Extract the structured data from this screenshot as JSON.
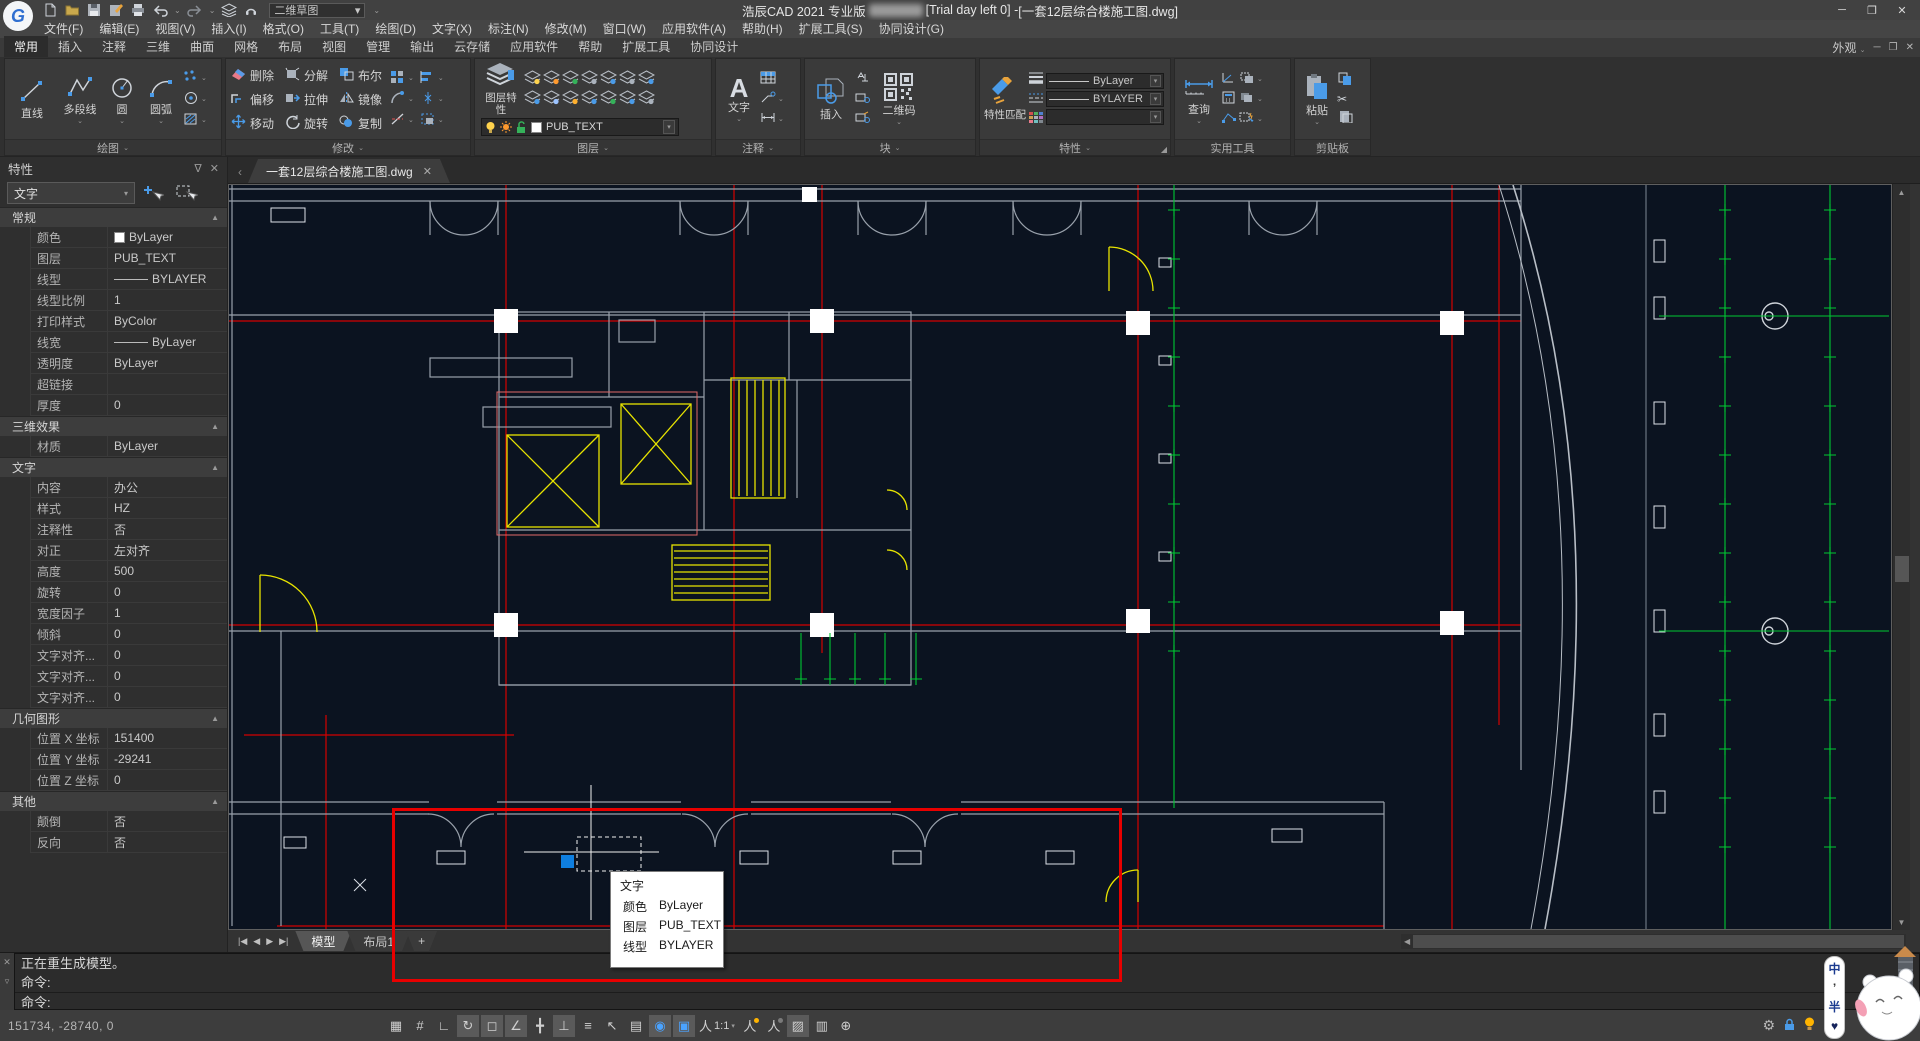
{
  "titlebar": {
    "app_name": "浩辰CAD 2021 专业版",
    "trial_text": "[Trial day left 0] - ",
    "doc_title": "[一套12层综合楼施工图.dwg]",
    "workspace": "二维草图",
    "minimize": "─",
    "maximize": "❐",
    "close": "✕"
  },
  "menu": {
    "items": [
      "文件(F)",
      "编辑(E)",
      "视图(V)",
      "插入(I)",
      "格式(O)",
      "工具(T)",
      "绘图(D)",
      "文字(X)",
      "标注(N)",
      "修改(M)",
      "窗口(W)",
      "应用软件(A)",
      "帮助(H)",
      "扩展工具(S)",
      "协同设计(G)"
    ]
  },
  "ribbon": {
    "tabs": [
      "常用",
      "插入",
      "注释",
      "三维",
      "曲面",
      "网格",
      "布局",
      "视图",
      "管理",
      "输出",
      "云存储",
      "应用软件",
      "帮助",
      "扩展工具",
      "协同设计"
    ],
    "active_tab": "常用",
    "appearance_label": "外观",
    "draw_panel": {
      "title": "绘图",
      "buttons": [
        "直线",
        "多段线",
        "圆",
        "圆弧"
      ]
    },
    "modify_panel": {
      "title": "修改",
      "buttons": [
        "删除",
        "分解",
        "布尔",
        "偏移",
        "拉伸",
        "镜像",
        "移动",
        "旋转",
        "复制"
      ]
    },
    "layer_panel": {
      "title": "图层",
      "big": "图层特性",
      "layer_value": "PUB_TEXT",
      "tool_dots": [
        "#ffd34d",
        "#ff9a2e",
        "#35b25a",
        "#aab2bc",
        "#4a9be8",
        "#aab2bc",
        "#4a9be8",
        "#4a9be8",
        "#9cc3ff",
        "#ffb02e",
        "#4a9be8",
        "#35b25a",
        "#4a9be8",
        "#aab2bc"
      ]
    },
    "annotate_panel": {
      "title": "注释",
      "big": "文字"
    },
    "block_panel": {
      "title": "块",
      "big": "插入",
      "qr": "二维码"
    },
    "props_panel": {
      "title": "特性",
      "big": "特性匹配",
      "combo1": "ByLayer",
      "combo2": "BYLAYER"
    },
    "utils_panel": {
      "title": "实用工具",
      "big": "查询"
    },
    "clipboard_panel": {
      "title": "剪贴板",
      "big": "粘贴"
    }
  },
  "properties": {
    "title": "特性",
    "selector": "文字",
    "sections": [
      {
        "name": "常规",
        "rows": [
          {
            "label": "颜色",
            "value": "ByLayer",
            "kind": "swatch"
          },
          {
            "label": "图层",
            "value": "PUB_TEXT",
            "kind": "text"
          },
          {
            "label": "线型",
            "value": "BYLAYER",
            "kind": "line"
          },
          {
            "label": "线型比例",
            "value": "1",
            "kind": "text"
          },
          {
            "label": "打印样式",
            "value": "ByColor",
            "kind": "text"
          },
          {
            "label": "线宽",
            "value": "ByLayer",
            "kind": "line"
          },
          {
            "label": "透明度",
            "value": "ByLayer",
            "kind": "text"
          },
          {
            "label": "超链接",
            "value": "",
            "kind": "text"
          },
          {
            "label": "厚度",
            "value": "0",
            "kind": "text"
          }
        ]
      },
      {
        "name": "三维效果",
        "rows": [
          {
            "label": "材质",
            "value": "ByLayer",
            "kind": "text"
          }
        ]
      },
      {
        "name": "文字",
        "rows": [
          {
            "label": "内容",
            "value": "办公",
            "kind": "text"
          },
          {
            "label": "样式",
            "value": "HZ",
            "kind": "text"
          },
          {
            "label": "注释性",
            "value": "否",
            "kind": "text"
          },
          {
            "label": "对正",
            "value": "左对齐",
            "kind": "text"
          },
          {
            "label": "高度",
            "value": "500",
            "kind": "text"
          },
          {
            "label": "旋转",
            "value": "0",
            "kind": "text"
          },
          {
            "label": "宽度因子",
            "value": "1",
            "kind": "text"
          },
          {
            "label": "倾斜",
            "value": "0",
            "kind": "text"
          },
          {
            "label": "文字对齐...",
            "value": "0",
            "kind": "text"
          },
          {
            "label": "文字对齐...",
            "value": "0",
            "kind": "text"
          },
          {
            "label": "文字对齐...",
            "value": "0",
            "kind": "text"
          }
        ]
      },
      {
        "name": "几何图形",
        "rows": [
          {
            "label": "位置 X 坐标",
            "value": "151400",
            "kind": "text"
          },
          {
            "label": "位置 Y 坐标",
            "value": "-29241",
            "kind": "text"
          },
          {
            "label": "位置 Z 坐标",
            "value": "0",
            "kind": "text"
          }
        ]
      },
      {
        "name": "其他",
        "rows": [
          {
            "label": "颠倒",
            "value": "否",
            "kind": "text"
          },
          {
            "label": "反向",
            "value": "否",
            "kind": "text"
          }
        ]
      }
    ]
  },
  "document_tab": {
    "label": "一套12层综合楼施工图.dwg",
    "close": "✕"
  },
  "layout_tabs": {
    "items": [
      "模型",
      "布局1",
      "+"
    ],
    "active": "模型"
  },
  "tooltip": {
    "title": "文字",
    "rows": [
      {
        "label": "颜色",
        "value": "ByLayer"
      },
      {
        "label": "图层",
        "value": "PUB_TEXT"
      },
      {
        "label": "线型",
        "value": "BYLAYER"
      }
    ]
  },
  "command": {
    "line1": "正在重生成模型。",
    "line2": "命令:",
    "line3": "命令:"
  },
  "statusbar": {
    "coords": "151734, -28740, 0",
    "tools": [
      {
        "name": "snap-toggle",
        "glyph": "▦",
        "active": false
      },
      {
        "name": "grid-toggle",
        "glyph": "#",
        "active": false
      },
      {
        "name": "ortho-toggle",
        "glyph": "∟",
        "active": false
      },
      {
        "name": "polar-tracking-toggle",
        "glyph": "↻",
        "active": true
      },
      {
        "name": "object-snap-toggle",
        "glyph": "◻",
        "active": true
      },
      {
        "name": "angle-snap-toggle",
        "glyph": "∠",
        "active": true
      },
      {
        "name": "snap-tracking-toggle",
        "glyph": "╋",
        "active": false
      },
      {
        "name": "ducs-toggle",
        "glyph": "⊥",
        "active": true
      },
      {
        "name": "linetype-display-toggle",
        "glyph": "≡",
        "active": false
      },
      {
        "name": "selection-preview-toggle",
        "glyph": "↖",
        "active": false
      },
      {
        "name": "layer-cycle-toggle",
        "glyph": "▤",
        "active": false
      },
      {
        "name": "selection-cycling-toggle",
        "glyph": "◉",
        "active": true,
        "blue": true
      },
      {
        "name": "quick-properties-toggle",
        "glyph": "▣",
        "active": true,
        "blue": true
      },
      {
        "name": "annotation-scale-control",
        "glyph": "人",
        "active": false,
        "scale": "1:1",
        "caret": "▾"
      },
      {
        "name": "annotation-visibility-toggle",
        "glyph": "人",
        "active": false,
        "dot": "#ffb400"
      },
      {
        "name": "auto-annotation-toggle",
        "glyph": "人",
        "active": false,
        "dot": "#7a7a7a"
      },
      {
        "name": "transparency-toggle",
        "glyph": "▨",
        "active": true
      },
      {
        "name": "properties-list-button",
        "glyph": "▥",
        "active": false
      },
      {
        "name": "clean-screen-toggle",
        "glyph": "⊕",
        "active": false
      }
    ]
  },
  "ime": {
    "chars": [
      "中",
      "’",
      "半",
      "♥"
    ]
  },
  "colors": {
    "annotation_red": "#e80000",
    "canvas_bg": "#0b1320",
    "cad_red": "#d40000",
    "cad_green": "#00c832",
    "cad_yellow": "#e8e400",
    "accent_blue": "#4a9be8"
  }
}
